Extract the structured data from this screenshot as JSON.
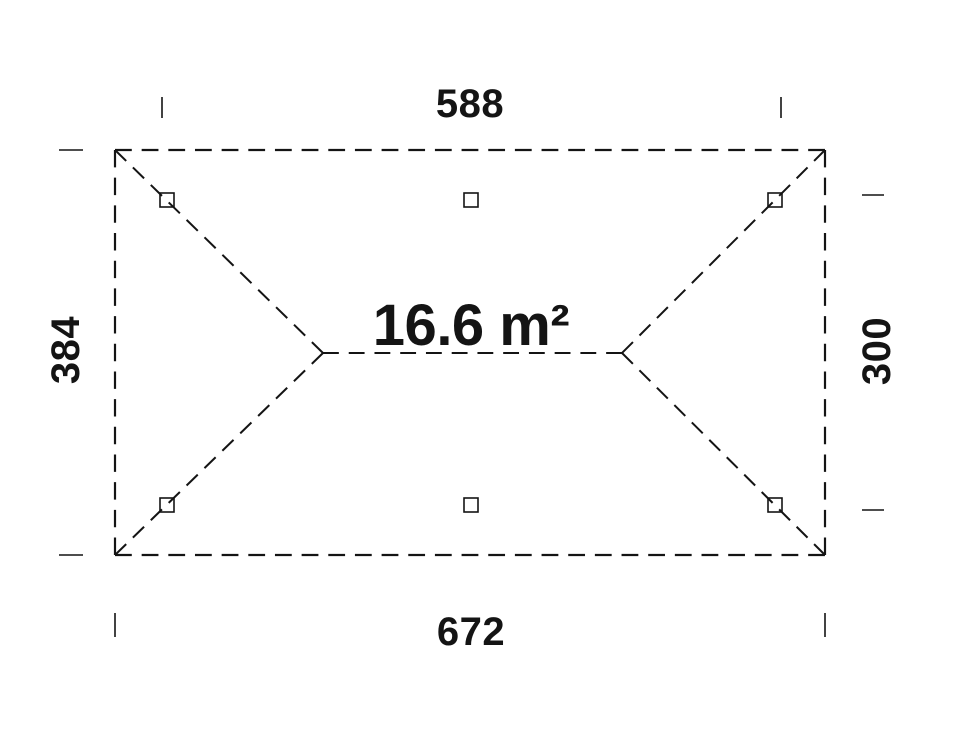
{
  "canvas": {
    "width": 963,
    "height": 730,
    "background": "#ffffff",
    "ink_color": "#141414"
  },
  "area_label": {
    "text": "16.6 m²",
    "x": 471,
    "y": 326
  },
  "dim_labels": [
    {
      "id": "top",
      "text": "588",
      "x": 470,
      "y": 104,
      "rotate": 0
    },
    {
      "id": "bottom",
      "text": "672",
      "x": 471,
      "y": 632,
      "rotate": 0
    },
    {
      "id": "left",
      "text": "384",
      "x": 66,
      "y": 350,
      "rotate": -90
    },
    {
      "id": "right",
      "text": "300",
      "x": 877,
      "y": 351,
      "rotate": -90
    }
  ],
  "outline": {
    "x1": 115,
    "y1": 150,
    "x2": 825,
    "y2": 555,
    "dash": 17,
    "gap": 10,
    "stroke_width": 2.2
  },
  "ridge": {
    "x1": 323,
    "y1": 353,
    "x2": 622,
    "y2": 353,
    "dash": 16,
    "gap": 10,
    "stroke_width": 2
  },
  "hips": [
    {
      "x1": 115,
      "y1": 150,
      "x2": 323,
      "y2": 353
    },
    {
      "x1": 115,
      "y1": 555,
      "x2": 323,
      "y2": 353
    },
    {
      "x1": 825,
      "y1": 150,
      "x2": 622,
      "y2": 353
    },
    {
      "x1": 825,
      "y1": 555,
      "x2": 622,
      "y2": 353
    }
  ],
  "hip_style": {
    "dash": 15,
    "gap": 9,
    "stroke_width": 2
  },
  "posts": [
    {
      "x": 167,
      "y": 200
    },
    {
      "x": 471,
      "y": 200
    },
    {
      "x": 775,
      "y": 200
    },
    {
      "x": 167,
      "y": 505
    },
    {
      "x": 471,
      "y": 505
    },
    {
      "x": 775,
      "y": 505
    }
  ],
  "post_style": {
    "size": 14,
    "stroke_width": 1.6
  },
  "ticks": [
    {
      "x1": 162,
      "y1": 97,
      "x2": 162,
      "y2": 118
    },
    {
      "x1": 781,
      "y1": 97,
      "x2": 781,
      "y2": 118
    },
    {
      "x1": 59,
      "y1": 150,
      "x2": 83,
      "y2": 150
    },
    {
      "x1": 59,
      "y1": 555,
      "x2": 83,
      "y2": 555
    },
    {
      "x1": 862,
      "y1": 195,
      "x2": 884,
      "y2": 195
    },
    {
      "x1": 862,
      "y1": 510,
      "x2": 884,
      "y2": 510
    },
    {
      "x1": 115,
      "y1": 613,
      "x2": 115,
      "y2": 637
    },
    {
      "x1": 825,
      "y1": 613,
      "x2": 825,
      "y2": 637
    }
  ],
  "tick_style": {
    "stroke_width": 1.6
  }
}
